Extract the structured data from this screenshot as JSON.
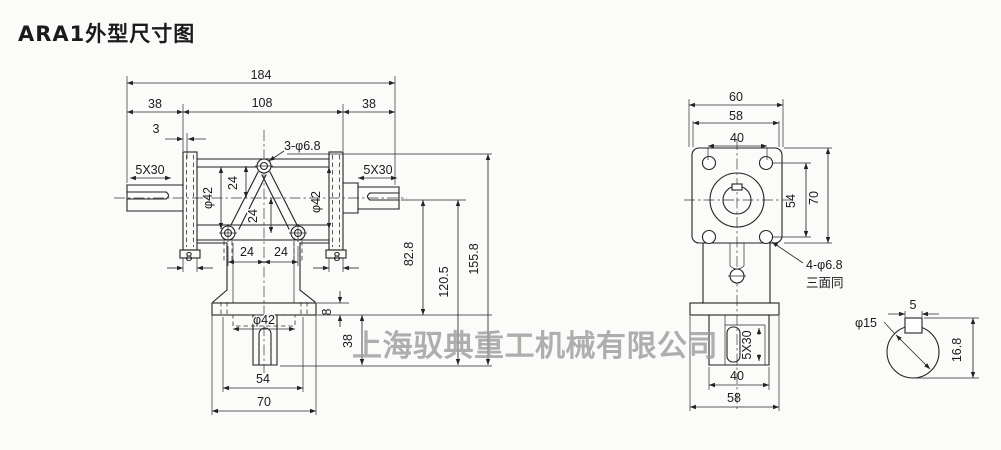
{
  "page": {
    "title": "ARA1外型尺寸图",
    "watermark": "上海驭典重工机械有限公司",
    "background": "#fbfbfa",
    "line_color": "#222222",
    "watermark_color": "#9c9c9c"
  },
  "front_view": {
    "description": "front view of ARA1 right-angle gearbox, two horizontal shafts and one downward output shaft",
    "dims": {
      "overall_width": "184",
      "left_shaft_ext": "38",
      "body_width": "108",
      "right_shaft_ext": "38",
      "flange_face_offset": "3",
      "mount_hole_callout": "3-φ6.8",
      "keyway_left": "5X30",
      "keyway_right": "5X30",
      "bolt_circle_left": "φ42",
      "bolt_circle_right": "φ42",
      "top_hole_to_axis": "24",
      "axis_to_bottom_holes": "24",
      "bottom_hole_pitch_left": "24",
      "bottom_hole_pitch_right": "24",
      "side_flange_thickness_left": "8",
      "side_flange_thickness_right": "8",
      "output_spigot_dia": "φ42",
      "output_flange_thickness": "8",
      "output_shaft_length": "38",
      "axis_to_flange_bottom": "82.8",
      "axis_to_shaft_end": "120.5",
      "top_hole_to_shaft_end": "155.8",
      "output_bolt_pitch": "54",
      "output_flange_width": "70"
    }
  },
  "side_view": {
    "description": "side view of mounting flange with four holes and downward output",
    "dims": {
      "overall_depth": "60",
      "flange_side": "58",
      "mount_hole_pitch_h": "40",
      "mount_hole_pitch_v": "54",
      "flange_height": "70",
      "mount_hole_callout": "4-φ6.8",
      "mount_hole_note": "三面同",
      "output_keyway": "5X30",
      "foot_width": "40",
      "bottom_flange_depth": "58"
    }
  },
  "shaft_section": {
    "description": "enlarged cross section of input shaft with key",
    "dims": {
      "key_width": "5",
      "shaft_dia": "φ15",
      "overall_height": "16.8"
    }
  }
}
